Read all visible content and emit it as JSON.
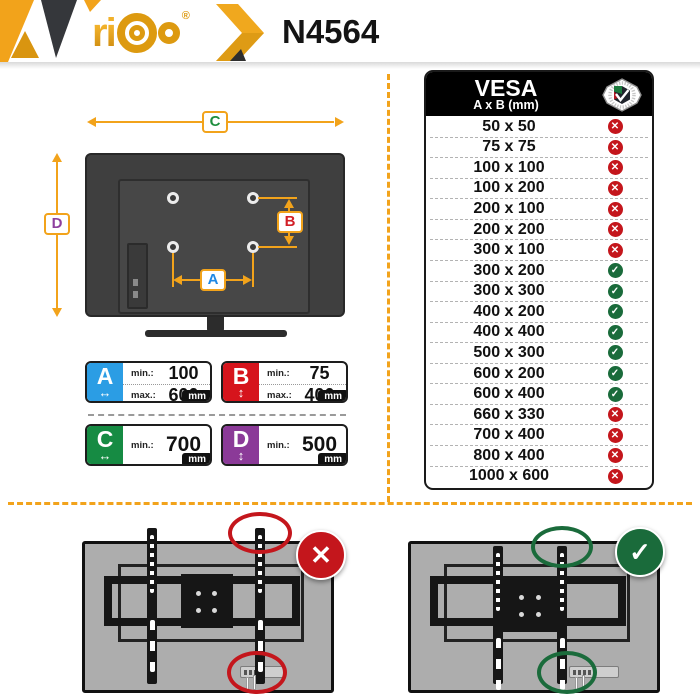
{
  "header": {
    "brand": "ri",
    "registered": "®",
    "model": "N4564"
  },
  "diagram": {
    "label_c": "C",
    "label_d": "D",
    "label_a": "A",
    "label_b": "B"
  },
  "dim_boxes": {
    "min_label": "min.:",
    "max_label": "max.:",
    "unit": "mm",
    "a": {
      "letter": "A",
      "arrow": "↔",
      "min": "100",
      "max": "600"
    },
    "b": {
      "letter": "B",
      "arrow": "↕",
      "min": "75",
      "max": "400"
    },
    "c": {
      "letter": "C",
      "arrow": "↔",
      "min": "700"
    },
    "d": {
      "letter": "D",
      "arrow": "↕",
      "min": "500"
    }
  },
  "vesa_table": {
    "title": "VESA",
    "subtitle": "A x B (mm)",
    "badge": "VESA mounting interface standard",
    "rows": [
      {
        "size": "50 x 50",
        "compatible": false
      },
      {
        "size": "75 x 75",
        "compatible": false
      },
      {
        "size": "100 x 100",
        "compatible": false
      },
      {
        "size": "100 x 200",
        "compatible": false
      },
      {
        "size": "200 x 100",
        "compatible": false
      },
      {
        "size": "200 x 200",
        "compatible": false
      },
      {
        "size": "300 x 100",
        "compatible": false
      },
      {
        "size": "300 x 200",
        "compatible": true
      },
      {
        "size": "300 x 300",
        "compatible": true
      },
      {
        "size": "400 x 200",
        "compatible": true
      },
      {
        "size": "400 x 400",
        "compatible": true
      },
      {
        "size": "500 x 300",
        "compatible": true
      },
      {
        "size": "600 x 200",
        "compatible": true
      },
      {
        "size": "600 x 400",
        "compatible": true
      },
      {
        "size": "660 x 330",
        "compatible": false
      },
      {
        "size": "700 x 400",
        "compatible": false
      },
      {
        "size": "800 x 400",
        "compatible": false
      },
      {
        "size": "1000 x 600",
        "compatible": false
      }
    ]
  },
  "icons": {
    "cross": "✕",
    "check": "✓"
  },
  "bottom": {
    "wrong_icon": "✕",
    "correct_icon": "✓"
  },
  "colors": {
    "accent": "#F2A31B",
    "accent_dark": "#C8860D",
    "dark": "#35373B",
    "tv_dark": "#3F3F3F",
    "red": "#C4161C",
    "green": "#1A6B3B",
    "blue": "#2B9DE4",
    "purple": "#8B3A98",
    "label_green": "#1E8E3E",
    "label_purple": "#8E3F9E",
    "label_blue": "#1E88E5",
    "label_red": "#D21F26",
    "gray_tv": "#ADADAD",
    "gold": "#DD9A10"
  }
}
